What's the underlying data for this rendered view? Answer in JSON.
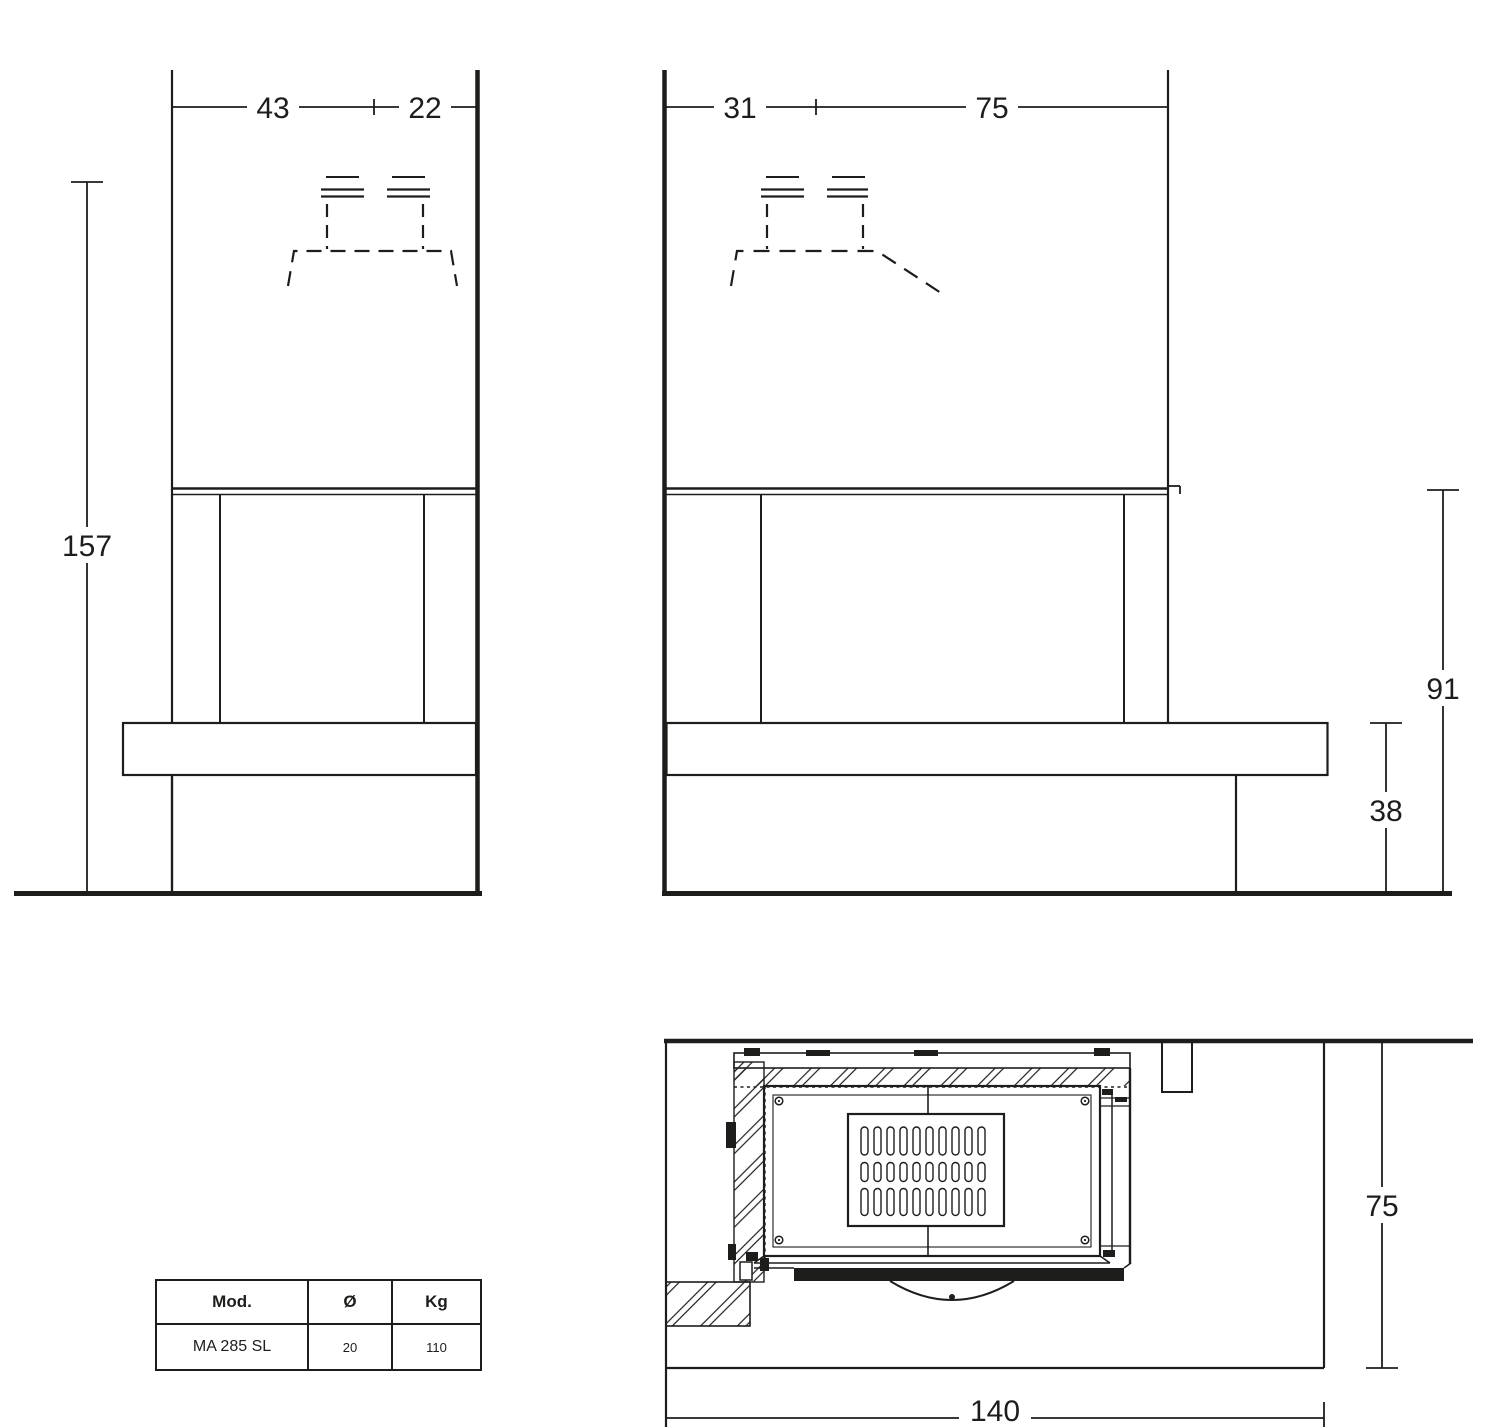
{
  "dimensions": {
    "front": {
      "width_left": "43",
      "width_right": "22",
      "total_height": "157"
    },
    "side": {
      "back_depth": "31",
      "front_depth": "75",
      "opening_height": "91",
      "bench_height": "38"
    },
    "plan": {
      "side_depth": "75",
      "front_width": "140"
    }
  },
  "spec_table": {
    "headers": {
      "model": "Mod.",
      "diameter": "Ø",
      "weight": "Kg"
    },
    "row": {
      "model": "MA 285 SL",
      "diameter": "20",
      "weight": "110"
    }
  },
  "colors": {
    "line": "#1d1d1b",
    "background": "#ffffff"
  }
}
